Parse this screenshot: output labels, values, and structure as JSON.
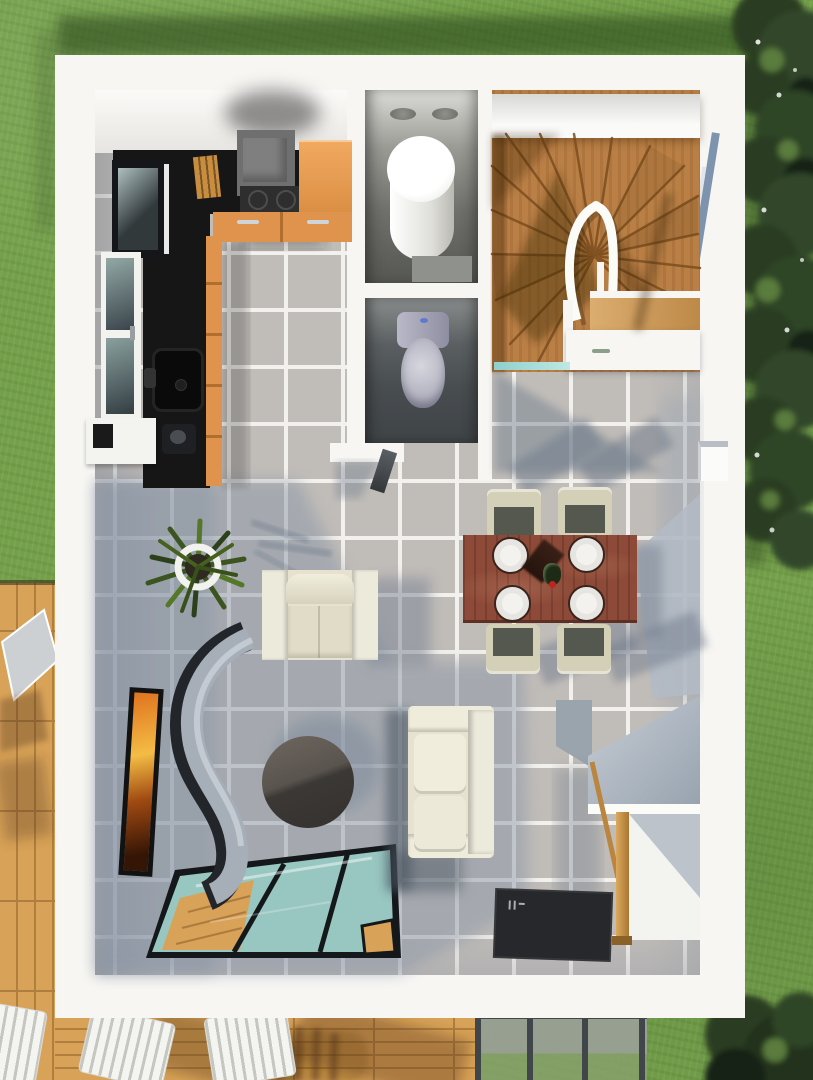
{
  "scene": {
    "type": "3d-floor-plan-render",
    "view": "top-down aerial of a single-storey house interior",
    "rooms": [
      {
        "name": "kitchen",
        "position": "top-left",
        "furniture": [
          "black L-shaped countertop",
          "cooker hood over hob",
          "orange cabinet and drawer fronts",
          "black square sink with faucet",
          "knife block",
          "glass-front tall cabinet",
          "side window",
          "coffee machine",
          "exterior wall box"
        ]
      },
      {
        "name": "utility-bathroom",
        "position": "top-middle",
        "furniture": [
          "white water-heater cylinder",
          "gray floor mat",
          "two ceiling vents"
        ]
      },
      {
        "name": "wc",
        "position": "middle",
        "furniture": [
          "toilet with lilac-gray lid",
          "open door leaf"
        ]
      },
      {
        "name": "staircase",
        "position": "top-right",
        "furniture": [
          "wooden winder stairs",
          "curved white handrail",
          "wooden landing platform",
          "under-stair cupboard with handle",
          "teal glass transom"
        ]
      },
      {
        "name": "dining-area",
        "position": "middle-right",
        "furniture": [
          "brown wooden table",
          "four white plates",
          "wine bottle",
          "four beige chairs with dark seats"
        ]
      },
      {
        "name": "living-area",
        "position": "bottom-left",
        "furniture": [
          "cream armchair",
          "cream two-seat sofa",
          "dark round coffee table",
          "potted spiky plant",
          "wavy gray room divider",
          "framed orange artwork",
          "glass floor panel over wooden lower level",
          "dark doormat"
        ]
      },
      {
        "name": "desk-nook",
        "position": "bottom-right",
        "furniture": [
          "wall desk with white shelf",
          "wooden post leg",
          "gray sloped panel"
        ]
      }
    ],
    "outdoor": [
      "lawn with building shadow",
      "dense hedge trees along right edge",
      "corner tree bottom-right",
      "wooden deck left and bottom",
      "two white slatted loungers",
      "lounger shadows",
      "folded gray parasol",
      "glass veranda roof with gray posts",
      "stone and grass visible through veranda glass"
    ]
  },
  "palette": {
    "grass": "#74a04a",
    "grassShadow": "#2f4a1f",
    "tree": "#2a3d22",
    "treeDark": "#182312",
    "treeHi": "#5a7c3e",
    "deck": "#d8a258",
    "deckLine": "#b07f3e",
    "wall": "#f7f6f3",
    "tile": "#c0bcb8",
    "grout": "#f3f1ed",
    "tileShadow": "#8b97a7",
    "counter": "#161616",
    "cabinet": "#e0934c",
    "hood": "#6f6f6f",
    "wood": "#b97f45",
    "woodLight": "#cf9a55",
    "table": "#8d4a38",
    "plate": "#f4f2ee",
    "chair": "#d4d0b8",
    "seat": "#55584e",
    "sofa": "#e6e2cf",
    "glass": "#a4d6cf",
    "frame": "#15181a",
    "mat": "#26282b",
    "toilet": "#a9a9bc",
    "teal": "#8fd0cc",
    "art1": "#e0731f",
    "art2": "#f4bc45",
    "divider": "#a6aeb8",
    "dividerEdge": "#22262b",
    "metal": "#9aa0a4",
    "post": "#41464a",
    "stone": "#9aa096"
  }
}
